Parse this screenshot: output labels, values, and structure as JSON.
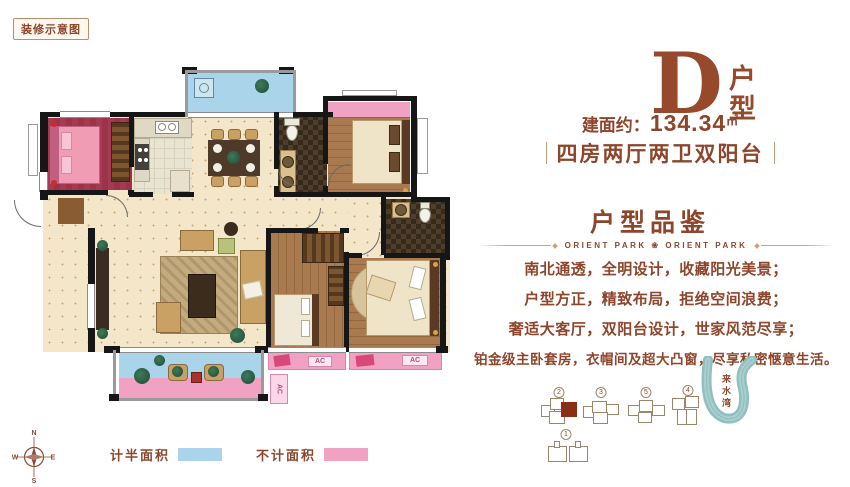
{
  "badge": {
    "label": "装修示意图"
  },
  "header": {
    "unit_letter": "D",
    "unit_suffix": "户型",
    "area_label": "建面约：",
    "area_value": "134.34",
    "area_unit": "㎡",
    "layout_summary": "四房两厅两卫双阳台"
  },
  "appreciation": {
    "heading": "户型品鉴",
    "divider_text": "ORIENT PARK ❀ ORIENT PARK",
    "description": [
      "南北通透，全明设计，收藏阳光美景；",
      "户型方正，精致布局，拒绝空间浪费；",
      "奢适大客厅，双阳台设计，世家风范尽享；",
      "铂金级主卧套房，衣帽间及超大凸窗，尽享私密惬意生活。"
    ]
  },
  "legend": {
    "items": [
      {
        "label": "计半面积",
        "color": "#a9d4ea"
      },
      {
        "label": "不计面积",
        "color": "#f1a2c2"
      }
    ]
  },
  "compass": {
    "north": "N",
    "east": "E",
    "south": "S",
    "west": "W"
  },
  "site_map": {
    "clusters": [
      {
        "number": "2",
        "highlighted": true
      },
      {
        "number": "3",
        "highlighted": false
      },
      {
        "number": "5",
        "highlighted": false
      },
      {
        "number": "4",
        "highlighted": false
      },
      {
        "number": "1",
        "highlighted": false
      }
    ],
    "river_label": "来水湾"
  },
  "floor_plan": {
    "ac_label": "AC"
  },
  "colors": {
    "brand_brown": "#8d452c",
    "half_area_blue": "#a9d4ea",
    "excluded_pink": "#f1a2c2",
    "river_teal": "#8fbfbf",
    "highlight_red": "#8a2f16",
    "wall_black": "#161616"
  }
}
